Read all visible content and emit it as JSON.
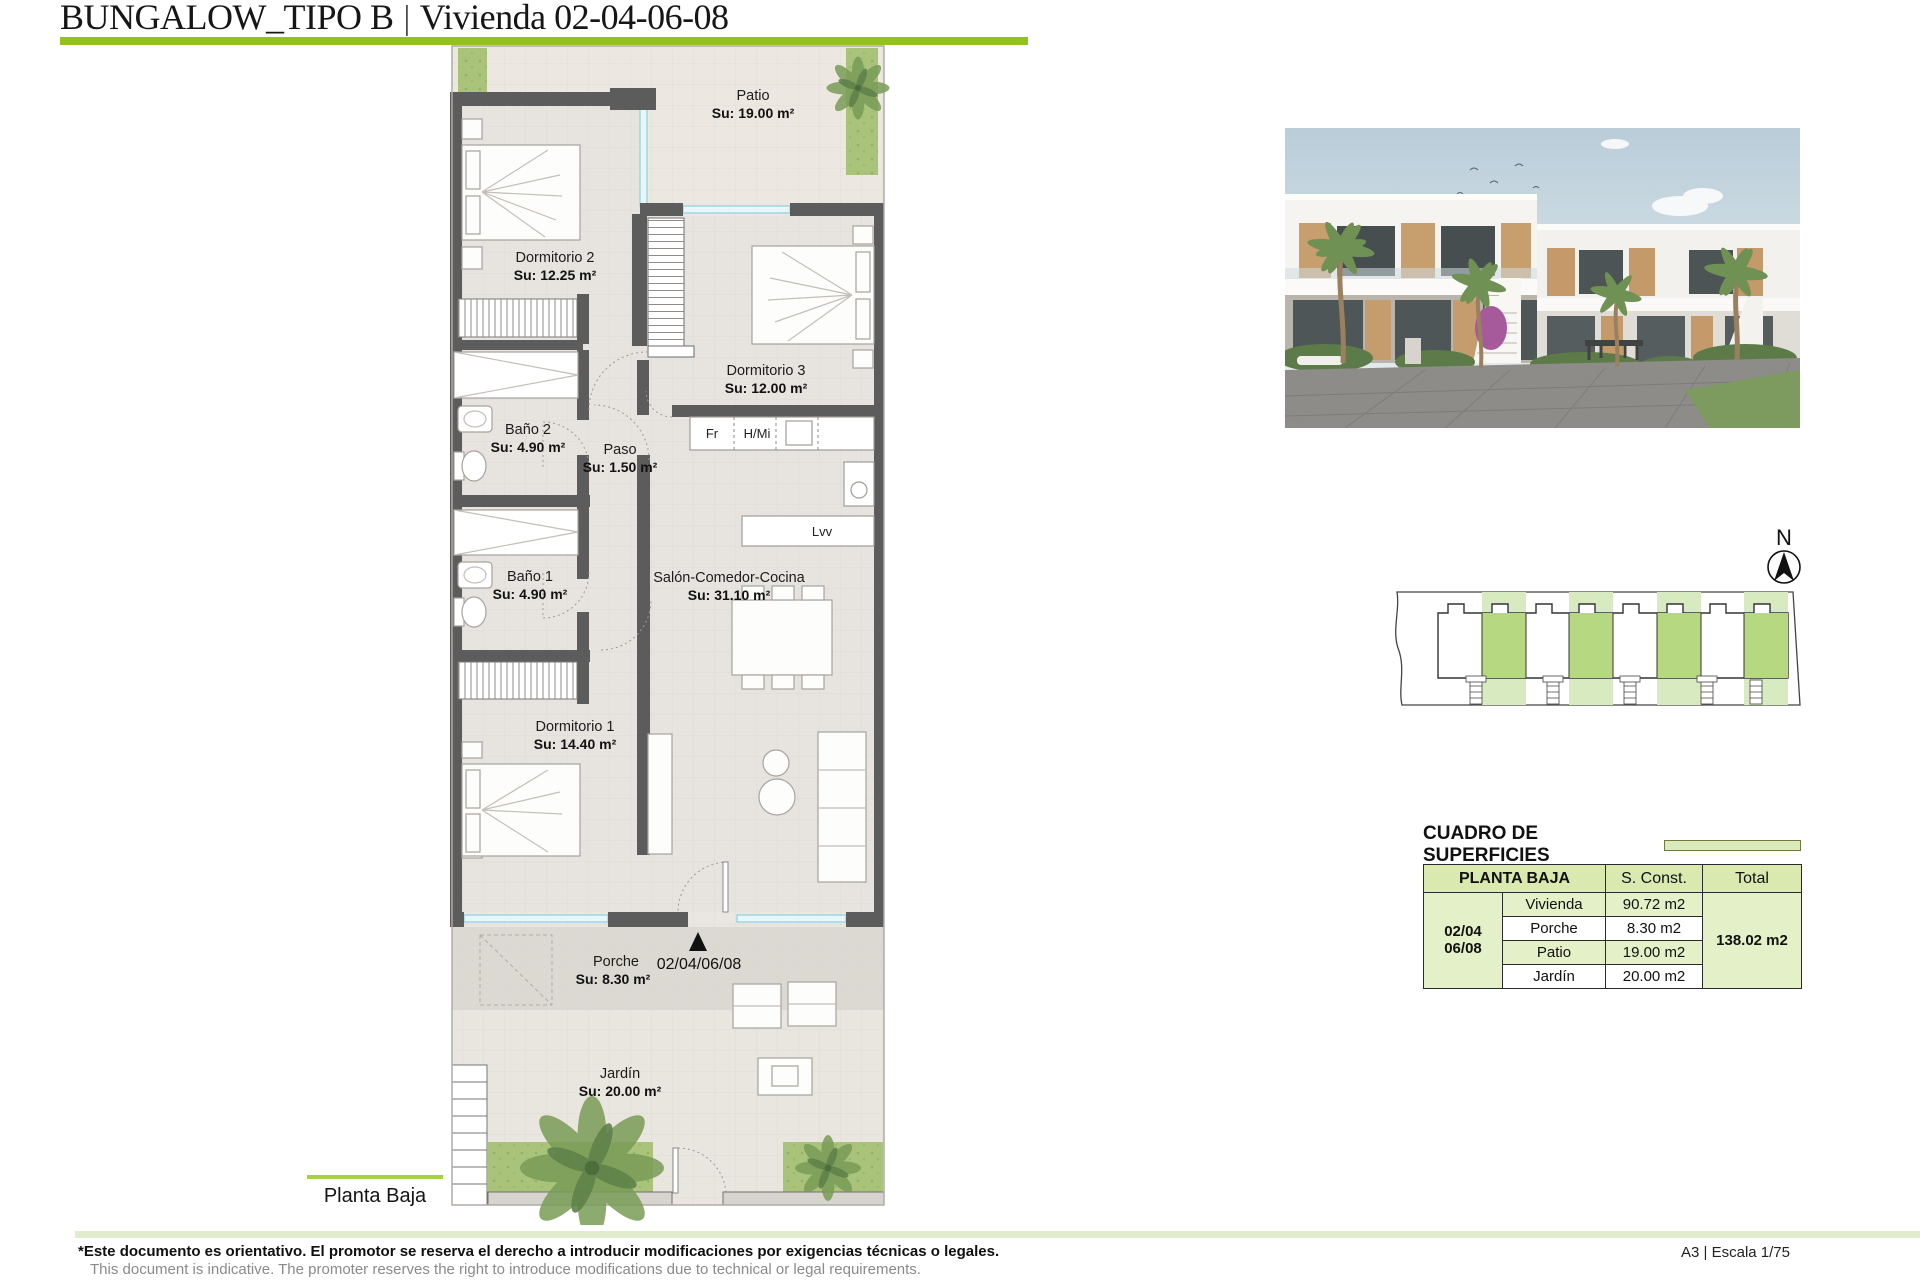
{
  "header": {
    "title": "BUNGALOW_TIPO B",
    "separator": "|",
    "subtitle": "Vivienda 02-04-06-08"
  },
  "plan": {
    "floor_label": "Planta Baja",
    "entrance_units": "02/04/06/08",
    "rooms": [
      {
        "name": "Patio",
        "area": "Su: 19.00 m²"
      },
      {
        "name": "Dormitorio 2",
        "area": "Su: 12.25 m²"
      },
      {
        "name": "Dormitorio 3",
        "area": "Su: 12.00 m²"
      },
      {
        "name": "Baño 2",
        "area": "Su: 4.90 m²"
      },
      {
        "name": "Paso",
        "area": "Su: 1.50 m²"
      },
      {
        "name": "Baño 1",
        "area": "Su: 4.90 m²"
      },
      {
        "name": "Salón-Comedor-Cocina",
        "area": "Su: 31.10 m²"
      },
      {
        "name": "Dormitorio 1",
        "area": "Su: 14.40 m²"
      },
      {
        "name": "Porche",
        "area": "Su: 8.30 m²"
      },
      {
        "name": "Jardín",
        "area": "Su: 20.00 m²"
      }
    ],
    "kitchen": {
      "fridge": "Fr",
      "oven_micro": "H/Mi",
      "dishwasher": "Lvv"
    }
  },
  "compass": {
    "north": "N"
  },
  "surfaces_table": {
    "title": "CUADRO DE SUPERFICIES",
    "columns": {
      "group": "PLANTA BAJA",
      "built": "S. Const.",
      "total": "Total"
    },
    "unit": {
      "line1": "02/04",
      "line2": "06/08"
    },
    "rows": [
      {
        "label": "Vivienda",
        "value": "90.72 m2"
      },
      {
        "label": "Porche",
        "value": "8.30 m2"
      },
      {
        "label": "Patio",
        "value": "19.00 m2"
      },
      {
        "label": "Jardín",
        "value": "20.00 m2"
      }
    ],
    "total": "138.02 m2"
  },
  "footer": {
    "disclaimer_es": "*Este documento es orientativo. El promotor se reserva el derecho a introducir modificaciones por exigencias técnicas o legales.",
    "disclaimer_en": "This document is indicative. The promoter reserves the right to introduce modifications due to technical or legal requirements.",
    "sheet_info": "A3 | Escala 1/75"
  },
  "colors": {
    "accent_green": "#93c11d",
    "table_header_green": "#d9e9b0",
    "table_row_green": "#e3f0c8",
    "site_green": "#b6d880",
    "grass_green": "#a9c47a",
    "wall_gray": "#5c5c5c",
    "window_cyan": "#8ed0e0"
  }
}
